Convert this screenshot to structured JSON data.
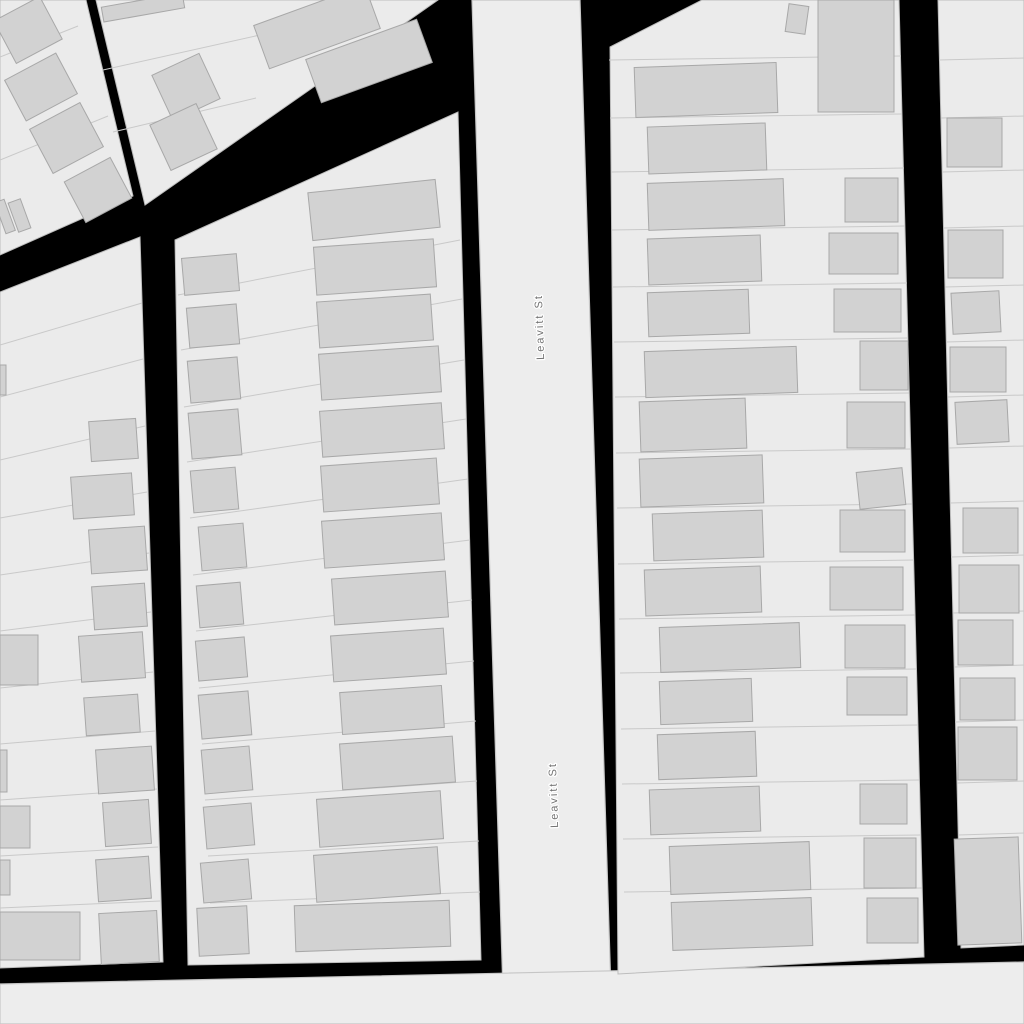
{
  "map": {
    "background_color": "#000000",
    "land_color": "#ebebeb",
    "block_stroke": "#bdbdbd",
    "parcel_line_color": "#c9c9c9",
    "building_fill": "#d2d2d2",
    "building_stroke": "#a8a8a8",
    "street_fill": "#ededed",
    "street_stroke": "#c6c6c6",
    "label_color": "#737373",
    "labels": [
      {
        "text": "Leavitt St",
        "x": 540,
        "y": 327,
        "rotation": -92
      },
      {
        "text": "Leavitt St",
        "x": 554,
        "y": 795,
        "rotation": -92
      }
    ],
    "roads": [
      {
        "id": "leavitt-st",
        "points": [
          [
            472,
            0
          ],
          [
            580,
            0
          ],
          [
            612,
            1024
          ],
          [
            504,
            1024
          ]
        ]
      },
      {
        "id": "cross-street",
        "points": [
          [
            0,
            984
          ],
          [
            1024,
            962
          ],
          [
            1024,
            1024
          ],
          [
            0,
            1024
          ]
        ]
      }
    ],
    "blocks": [
      {
        "id": "block-northwest-upper",
        "outline": [
          [
            0,
            0
          ],
          [
            86,
            0
          ],
          [
            133,
            196
          ],
          [
            0,
            255
          ]
        ],
        "parcel_lines": [
          [
            0,
            57,
            78,
            26
          ],
          [
            0,
            160,
            108,
            116
          ]
        ],
        "buildings_xywhr": [
          [
            2,
            6,
            52,
            48,
            -28
          ],
          [
            12,
            64,
            58,
            46,
            -28
          ],
          [
            38,
            113,
            57,
            50,
            -28
          ],
          [
            72,
            167,
            52,
            46,
            -28
          ],
          [
            0,
            200,
            10,
            33,
            -20
          ],
          [
            13,
            200,
            13,
            31,
            -20
          ]
        ]
      },
      {
        "id": "block-north-triangle",
        "outline": [
          [
            96,
            0
          ],
          [
            438,
            0
          ],
          [
            145,
            205
          ]
        ],
        "parcel_lines": [
          [
            103,
            70,
            345,
            16
          ],
          [
            113,
            132,
            256,
            98
          ]
        ],
        "buildings_xywhr": [
          [
            102,
            0,
            82,
            15,
            -10
          ],
          [
            160,
            62,
            52,
            50,
            -25
          ],
          [
            158,
            112,
            51,
            50,
            -25
          ],
          [
            258,
            4,
            118,
            46,
            -20
          ],
          [
            310,
            38,
            118,
            46,
            -20
          ]
        ]
      },
      {
        "id": "block-west",
        "outline": [
          [
            0,
            292
          ],
          [
            140,
            237
          ],
          [
            163,
            962
          ],
          [
            0,
            968
          ]
        ],
        "parcel_lines": [
          [
            0,
            345,
            142,
            303
          ],
          [
            0,
            397,
            143,
            359
          ],
          [
            0,
            460,
            145,
            426
          ],
          [
            0,
            518,
            147,
            492
          ],
          [
            0,
            575,
            149,
            553
          ],
          [
            0,
            631,
            151,
            612
          ],
          [
            0,
            688,
            153,
            672
          ],
          [
            0,
            744,
            155,
            731
          ],
          [
            0,
            800,
            157,
            789
          ],
          [
            0,
            856,
            158,
            847
          ],
          [
            0,
            908,
            160,
            901
          ]
        ],
        "buildings_xywhr": [
          [
            0,
            365,
            6,
            30,
            0
          ],
          [
            90,
            420,
            47,
            40,
            -4
          ],
          [
            72,
            475,
            61,
            42,
            -4
          ],
          [
            90,
            528,
            56,
            44,
            -4
          ],
          [
            93,
            585,
            53,
            43,
            -4
          ],
          [
            0,
            635,
            38,
            50,
            0
          ],
          [
            80,
            634,
            64,
            46,
            -4
          ],
          [
            85,
            696,
            54,
            38,
            -4
          ],
          [
            0,
            750,
            7,
            42,
            0
          ],
          [
            97,
            748,
            56,
            44,
            -4
          ],
          [
            0,
            806,
            30,
            42,
            0
          ],
          [
            104,
            801,
            46,
            44,
            -4
          ],
          [
            0,
            860,
            10,
            35,
            0
          ],
          [
            97,
            858,
            53,
            42,
            -4
          ],
          [
            0,
            912,
            80,
            48,
            0
          ],
          [
            100,
            912,
            58,
            51,
            -3
          ]
        ]
      },
      {
        "id": "block-center-west-of-leavitt",
        "outline": [
          [
            175,
            240
          ],
          [
            458,
            112
          ],
          [
            481,
            960
          ],
          [
            188,
            965
          ]
        ],
        "parcel_lines": [
          [
            178,
            295,
            460,
            240
          ],
          [
            181,
            350,
            462,
            299
          ],
          [
            184,
            407,
            464,
            360
          ],
          [
            187,
            462,
            466,
            419
          ],
          [
            190,
            518,
            468,
            479
          ],
          [
            193,
            575,
            470,
            540
          ],
          [
            196,
            631,
            472,
            600
          ],
          [
            199,
            688,
            474,
            661
          ],
          [
            202,
            744,
            476,
            721
          ],
          [
            205,
            800,
            477,
            781
          ],
          [
            208,
            856,
            479,
            841
          ],
          [
            210,
            903,
            480,
            892
          ]
        ],
        "buildings_xywhr": [
          [
            310,
            186,
            128,
            48,
            -6
          ],
          [
            315,
            243,
            120,
            48,
            -4
          ],
          [
            318,
            298,
            114,
            46,
            -4
          ],
          [
            320,
            350,
            120,
            46,
            -4
          ],
          [
            321,
            407,
            122,
            46,
            -4
          ],
          [
            322,
            462,
            116,
            46,
            -4
          ],
          [
            323,
            517,
            120,
            47,
            -4
          ],
          [
            333,
            575,
            114,
            46,
            -4
          ],
          [
            332,
            632,
            113,
            46,
            -4
          ],
          [
            341,
            689,
            102,
            42,
            -4
          ],
          [
            341,
            740,
            113,
            46,
            -4
          ],
          [
            318,
            795,
            124,
            48,
            -4
          ],
          [
            315,
            851,
            124,
            47,
            -4
          ],
          [
            295,
            903,
            155,
            46,
            -2
          ],
          [
            183,
            256,
            55,
            37,
            -5
          ],
          [
            188,
            306,
            50,
            40,
            -5
          ],
          [
            189,
            359,
            50,
            42,
            -5
          ],
          [
            190,
            411,
            50,
            46,
            -5
          ],
          [
            192,
            469,
            45,
            42,
            -5
          ],
          [
            200,
            525,
            45,
            44,
            -5
          ],
          [
            198,
            584,
            44,
            42,
            -5
          ],
          [
            197,
            639,
            49,
            40,
            -5
          ],
          [
            200,
            693,
            50,
            44,
            -5
          ],
          [
            203,
            748,
            48,
            44,
            -5
          ],
          [
            205,
            805,
            48,
            42,
            -5
          ],
          [
            202,
            861,
            48,
            40,
            -5
          ],
          [
            198,
            907,
            50,
            48,
            -3
          ]
        ]
      },
      {
        "id": "block-east-of-leavitt",
        "outline": [
          [
            610,
            47
          ],
          [
            702,
            0
          ],
          [
            899,
            0
          ],
          [
            924,
            957
          ],
          [
            618,
            974
          ]
        ],
        "parcel_lines": [
          [
            609,
            60,
            901,
            56
          ],
          [
            610,
            118,
            902,
            114
          ],
          [
            611,
            172,
            904,
            168
          ],
          [
            612,
            230,
            905,
            226
          ],
          [
            613,
            287,
            907,
            283
          ],
          [
            614,
            342,
            908,
            338
          ],
          [
            615,
            397,
            909,
            393
          ],
          [
            616,
            453,
            911,
            449
          ],
          [
            617,
            508,
            912,
            504
          ],
          [
            618,
            564,
            914,
            560
          ],
          [
            619,
            619,
            915,
            615
          ],
          [
            620,
            673,
            916,
            669
          ],
          [
            621,
            729,
            918,
            725
          ],
          [
            622,
            784,
            919,
            780
          ],
          [
            623,
            839,
            921,
            835
          ],
          [
            624,
            892,
            922,
            888
          ]
        ],
        "buildings_xywhr": [
          [
            635,
            65,
            142,
            50,
            -2
          ],
          [
            648,
            125,
            118,
            47,
            -2
          ],
          [
            648,
            181,
            136,
            47,
            -2
          ],
          [
            648,
            237,
            113,
            46,
            -2
          ],
          [
            648,
            291,
            101,
            44,
            -2
          ],
          [
            645,
            349,
            152,
            46,
            -2
          ],
          [
            640,
            400,
            106,
            50,
            -2
          ],
          [
            640,
            457,
            123,
            48,
            -2
          ],
          [
            653,
            512,
            110,
            47,
            -2
          ],
          [
            645,
            568,
            116,
            46,
            -2
          ],
          [
            660,
            625,
            140,
            45,
            -2
          ],
          [
            660,
            680,
            92,
            43,
            -2
          ],
          [
            658,
            733,
            98,
            45,
            -2
          ],
          [
            650,
            788,
            110,
            45,
            -2
          ],
          [
            670,
            844,
            140,
            48,
            -2
          ],
          [
            672,
            900,
            140,
            48,
            -2
          ],
          [
            818,
            0,
            76,
            112,
            0
          ],
          [
            787,
            5,
            20,
            28,
            8
          ],
          [
            845,
            178,
            53,
            44,
            0
          ],
          [
            829,
            233,
            69,
            41,
            0
          ],
          [
            834,
            289,
            67,
            43,
            0
          ],
          [
            860,
            341,
            48,
            49,
            0
          ],
          [
            847,
            402,
            58,
            46,
            0
          ],
          [
            858,
            470,
            46,
            37,
            -6
          ],
          [
            840,
            510,
            65,
            42,
            0
          ],
          [
            830,
            567,
            73,
            43,
            0
          ],
          [
            845,
            625,
            60,
            43,
            0
          ],
          [
            847,
            677,
            60,
            38,
            0
          ],
          [
            860,
            784,
            47,
            40,
            0
          ],
          [
            864,
            838,
            52,
            50,
            0
          ],
          [
            867,
            898,
            51,
            45,
            0
          ]
        ]
      },
      {
        "id": "block-far-east",
        "outline": [
          [
            938,
            0
          ],
          [
            1024,
            0
          ],
          [
            1024,
            945
          ],
          [
            961,
            948
          ]
        ],
        "parcel_lines": [
          [
            939,
            60,
            1024,
            58
          ],
          [
            941,
            118,
            1024,
            116
          ],
          [
            942,
            172,
            1024,
            170
          ],
          [
            944,
            228,
            1024,
            226
          ],
          [
            945,
            287,
            1024,
            285
          ],
          [
            946,
            342,
            1024,
            340
          ],
          [
            948,
            397,
            1024,
            395
          ],
          [
            949,
            448,
            1024,
            446
          ],
          [
            950,
            503,
            1024,
            501
          ],
          [
            951,
            557,
            1024,
            555
          ],
          [
            953,
            613,
            1024,
            611
          ],
          [
            954,
            667,
            1024,
            665
          ],
          [
            955,
            722,
            1024,
            720
          ],
          [
            957,
            783,
            1024,
            781
          ],
          [
            958,
            835,
            1024,
            833
          ]
        ],
        "buildings_xywhr": [
          [
            947,
            118,
            55,
            49,
            0
          ],
          [
            948,
            230,
            55,
            48,
            0
          ],
          [
            952,
            292,
            48,
            41,
            -3
          ],
          [
            950,
            347,
            56,
            45,
            0
          ],
          [
            956,
            401,
            52,
            42,
            -3
          ],
          [
            963,
            508,
            55,
            45,
            0
          ],
          [
            959,
            565,
            60,
            48,
            0
          ],
          [
            958,
            620,
            55,
            45,
            0
          ],
          [
            960,
            678,
            55,
            42,
            0
          ],
          [
            958,
            727,
            59,
            53,
            0
          ],
          [
            956,
            838,
            64,
            106,
            -2
          ]
        ]
      }
    ]
  }
}
